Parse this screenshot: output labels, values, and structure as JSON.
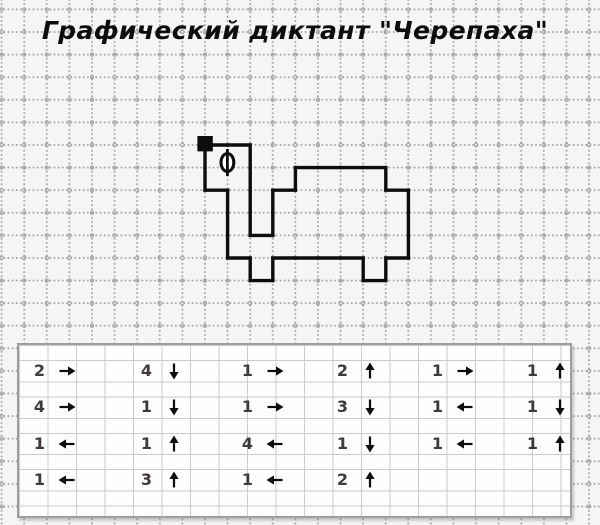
{
  "title": "Графический диктант \"Черепаха\"",
  "colors": {
    "ink": "#0d0d0d",
    "digit": "#3f3b3b",
    "paper": "#f5f5f3",
    "grid_dot": "#a5a5a5",
    "table_line": "#cbcbcb",
    "table_border": "#9e9e9e",
    "table_bg": "#fdfdfc"
  },
  "worksheet": {
    "cell_px": 22.6,
    "start_point": {
      "x": 205,
      "y": 145
    },
    "steps": [
      {
        "n": 2,
        "dir": "right"
      },
      {
        "n": 4,
        "dir": "down"
      },
      {
        "n": 1,
        "dir": "right"
      },
      {
        "n": 2,
        "dir": "up"
      },
      {
        "n": 1,
        "dir": "right"
      },
      {
        "n": 1,
        "dir": "up"
      },
      {
        "n": 4,
        "dir": "right"
      },
      {
        "n": 1,
        "dir": "down"
      },
      {
        "n": 1,
        "dir": "right"
      },
      {
        "n": 3,
        "dir": "down"
      },
      {
        "n": 1,
        "dir": "left"
      },
      {
        "n": 1,
        "dir": "down"
      },
      {
        "n": 1,
        "dir": "left"
      },
      {
        "n": 1,
        "dir": "up"
      },
      {
        "n": 4,
        "dir": "left"
      },
      {
        "n": 1,
        "dir": "down"
      },
      {
        "n": 1,
        "dir": "left"
      },
      {
        "n": 1,
        "dir": "up"
      },
      {
        "n": 1,
        "dir": "left"
      },
      {
        "n": 3,
        "dir": "up"
      },
      {
        "n": 1,
        "dir": "left"
      },
      {
        "n": 2,
        "dir": "up"
      }
    ],
    "table_rows": [
      6,
      6,
      6,
      4
    ]
  }
}
